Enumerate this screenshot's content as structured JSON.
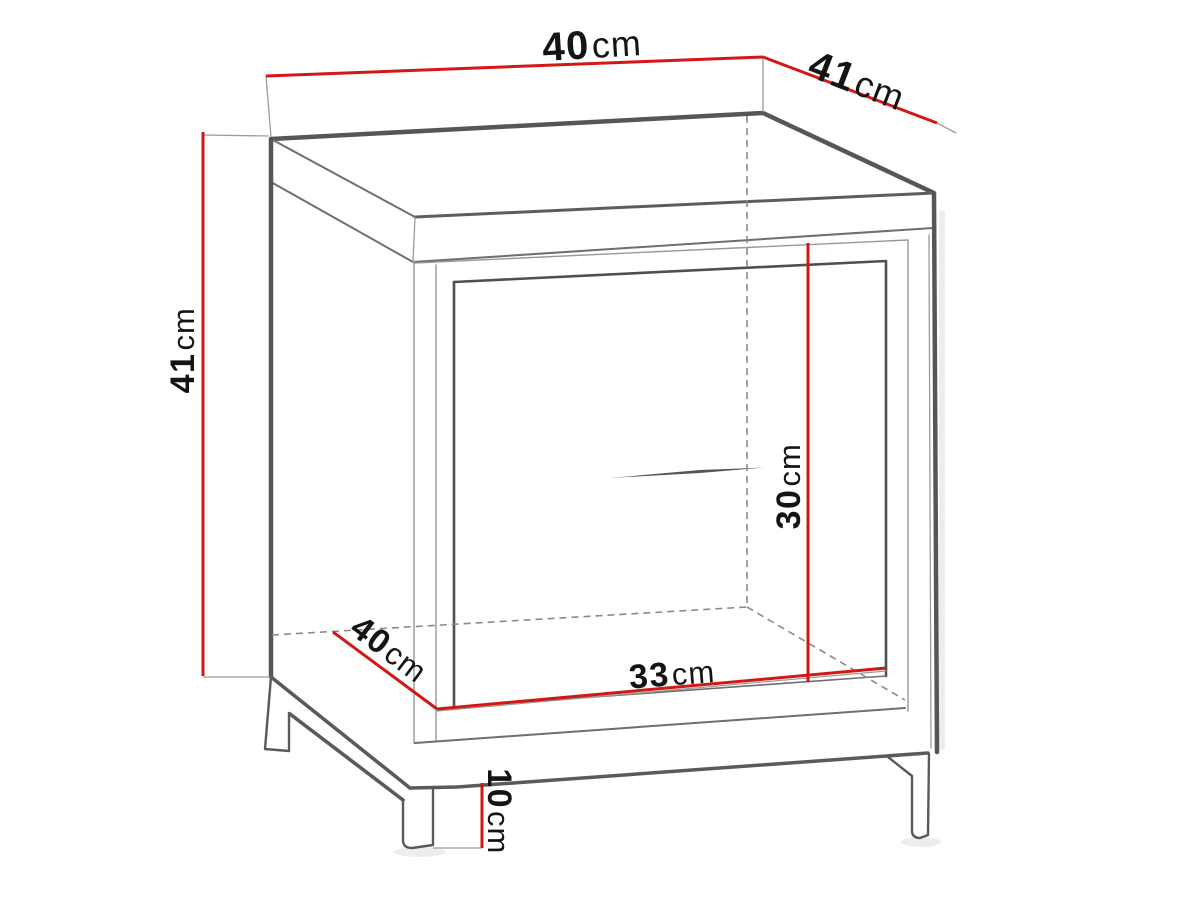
{
  "diagram": {
    "type": "furniture-dimension-drawing",
    "subject": "bedside cabinet / nightstand technical line drawing with red dimension lines",
    "background_color": "#ffffff",
    "colors": {
      "dimension_line": "#d31717",
      "outline_dark": "#565656",
      "outline_medium": "#6e6e6e",
      "outline_thin": "#9a9a9a",
      "dashed_line": "#8a8a8a",
      "label_text": "#141414"
    },
    "dimensions": [
      {
        "id": "top-width",
        "value": "40",
        "unit": "cm"
      },
      {
        "id": "top-depth",
        "value": "41",
        "unit": "cm"
      },
      {
        "id": "height",
        "value": "41",
        "unit": "cm"
      },
      {
        "id": "interior-height",
        "value": "30",
        "unit": "cm"
      },
      {
        "id": "interior-depth",
        "value": "40",
        "unit": "cm"
      },
      {
        "id": "interior-width",
        "value": "33",
        "unit": "cm"
      },
      {
        "id": "leg-height",
        "value": "10",
        "unit": "cm"
      }
    ]
  }
}
